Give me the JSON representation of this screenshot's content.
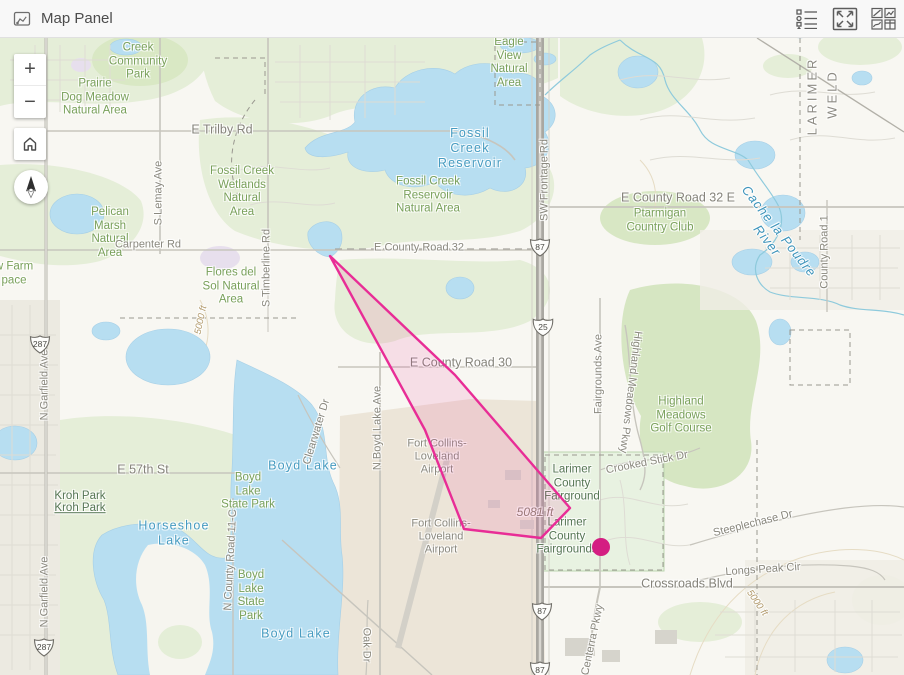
{
  "header": {
    "title": "Map Panel",
    "icons": [
      {
        "name": "legend-icon"
      },
      {
        "name": "expand-icon"
      },
      {
        "name": "panels-icon"
      }
    ]
  },
  "controls": {
    "zoom_in_label": "+",
    "zoom_out_label": "−"
  },
  "map": {
    "colors": {
      "overlay_stroke": "#e82d96",
      "overlay_fill": "rgba(237,45,146,0.12)",
      "dot_fill": "#d41e82"
    },
    "overlay": {
      "polygon": [
        [
          330,
          256
        ],
        [
          455,
          375
        ],
        [
          570,
          508
        ],
        [
          541,
          538
        ],
        [
          464,
          529
        ],
        [
          425,
          430
        ]
      ],
      "dot": {
        "x": 601,
        "y": 547,
        "r": 9
      }
    },
    "shields": [
      {
        "kind": "us",
        "label": "287",
        "x": 40,
        "y": 347
      },
      {
        "kind": "us",
        "label": "287",
        "x": 44,
        "y": 650
      },
      {
        "kind": "us",
        "label": "87",
        "x": 540,
        "y": 250
      },
      {
        "kind": "interstate",
        "label": "25",
        "x": 543,
        "y": 330
      },
      {
        "kind": "us",
        "label": "87",
        "x": 542,
        "y": 614
      },
      {
        "kind": "us",
        "label": "87",
        "x": 540,
        "y": 673
      }
    ],
    "labels": [
      {
        "t": "Creek\nCommunity\nPark",
        "x": 138,
        "y": 62,
        "cls": "park"
      },
      {
        "t": "Prairie\nDog Meadow\nNatural Area",
        "x": 95,
        "y": 98,
        "cls": "park"
      },
      {
        "t": "Fossil Creek\nWetlands\nNatural\nArea",
        "x": 242,
        "y": 192,
        "cls": "park"
      },
      {
        "t": "Fossil Creek\nReservoir\nNatural Area",
        "x": 428,
        "y": 196,
        "cls": "park"
      },
      {
        "t": "Eagle\nView\nNatural\nArea",
        "x": 509,
        "y": 63,
        "cls": "park"
      },
      {
        "t": "Pelican\nMarsh\nNatural\nArea",
        "x": 110,
        "y": 233,
        "cls": "park"
      },
      {
        "t": "Flores del\nSol Natural\nArea",
        "x": 231,
        "y": 287,
        "cls": "park"
      },
      {
        "t": "w Farm\npace",
        "x": 14,
        "y": 274,
        "cls": "park"
      },
      {
        "t": "Ptarmigan\nCountry Club",
        "x": 660,
        "y": 221,
        "cls": "park"
      },
      {
        "t": "Highland\nMeadows\nGolf Course",
        "x": 681,
        "y": 416,
        "cls": "park"
      },
      {
        "t": "Boyd\nLake\nState Park",
        "x": 248,
        "y": 492,
        "cls": "park"
      },
      {
        "t": "Boyd\nLake\nState\nPark",
        "x": 251,
        "y": 596,
        "cls": "park"
      },
      {
        "t": "Kroh Park",
        "x": 80,
        "y": 497,
        "cls": "park-dk"
      },
      {
        "t": "Kroh Park",
        "x": 80,
        "y": 509,
        "cls": "park-dk u"
      },
      {
        "t": "Larimer\nCounty\nFairground",
        "x": 572,
        "y": 484,
        "cls": "park-dk"
      },
      {
        "t": "Larimer\nCounty\nFairgrounds",
        "x": 567,
        "y": 537,
        "cls": "park-dk"
      },
      {
        "t": "Fossil\nCreek\nReservoir",
        "x": 470,
        "y": 148,
        "cls": "water-lg"
      },
      {
        "t": "Boyd Lake",
        "x": 303,
        "y": 466,
        "cls": "water-lg"
      },
      {
        "t": "Boyd Lake",
        "x": 296,
        "y": 634,
        "cls": "water-lg"
      },
      {
        "t": "Horseshoe\nLake",
        "x": 174,
        "y": 533,
        "cls": "water-lg"
      },
      {
        "t": "Cache la Poudre River",
        "x": 773,
        "y": 236,
        "cls": "water-it",
        "rot": 52
      },
      {
        "t": "Fort Collins-\nLoveland\nAirport",
        "x": 437,
        "y": 457,
        "cls": "road"
      },
      {
        "t": "Fort Collins-\nLoveland\nAirport",
        "x": 441,
        "y": 537,
        "cls": "road"
      },
      {
        "t": "E Trilby Rd",
        "x": 222,
        "y": 130,
        "cls": "road-lg"
      },
      {
        "t": "Carpenter Rd",
        "x": 148,
        "y": 245,
        "cls": "road"
      },
      {
        "t": "E County Road 32",
        "x": 419,
        "y": 248,
        "cls": "road"
      },
      {
        "t": "E County Road 30",
        "x": 461,
        "y": 363,
        "cls": "road-lg"
      },
      {
        "t": "E County Road 32 E",
        "x": 678,
        "y": 198,
        "cls": "road-lg"
      },
      {
        "t": "E 57th St",
        "x": 143,
        "y": 470,
        "cls": "road-lg"
      },
      {
        "t": "Crossroads Blvd",
        "x": 687,
        "y": 584,
        "cls": "road-lg"
      },
      {
        "t": "Longs Peak Cir",
        "x": 763,
        "y": 570,
        "cls": "road",
        "rot": -4
      },
      {
        "t": "Steeplechase Dr",
        "x": 753,
        "y": 524,
        "cls": "road",
        "rot": -14
      },
      {
        "t": "Crooked Stick Dr",
        "x": 647,
        "y": 463,
        "cls": "road",
        "rot": -11
      },
      {
        "t": "S Lemay Ave",
        "x": 159,
        "y": 193,
        "cls": "road",
        "rot": -90
      },
      {
        "t": "S Timberline Rd",
        "x": 267,
        "y": 268,
        "cls": "road",
        "rot": -90
      },
      {
        "t": "N Boyd Lake Ave",
        "x": 378,
        "y": 428,
        "cls": "road",
        "rot": -90
      },
      {
        "t": "Clearwater Dr",
        "x": 317,
        "y": 432,
        "cls": "road",
        "rot": -73
      },
      {
        "t": "Fairgrounds Ave",
        "x": 599,
        "y": 374,
        "cls": "road",
        "rot": -90
      },
      {
        "t": "Highland Meadows Pkwy",
        "x": 630,
        "y": 392,
        "cls": "road",
        "rot": 97
      },
      {
        "t": "SW Frontage Rd",
        "x": 545,
        "y": 180,
        "cls": "road",
        "rot": -90
      },
      {
        "t": "N Garfield Ave",
        "x": 45,
        "y": 385,
        "cls": "road",
        "rot": -90
      },
      {
        "t": "N Garfield Ave",
        "x": 45,
        "y": 592,
        "cls": "road",
        "rot": -90
      },
      {
        "t": "N County Road 11-C",
        "x": 231,
        "y": 560,
        "cls": "road",
        "rot": -87
      },
      {
        "t": "County Road 1",
        "x": 825,
        "y": 252,
        "cls": "road",
        "rot": -90
      },
      {
        "t": "Centerra Pkwy",
        "x": 593,
        "y": 640,
        "cls": "road",
        "rot": -78
      },
      {
        "t": "Oak Dr",
        "x": 366,
        "y": 645,
        "cls": "road",
        "rot": 90
      },
      {
        "t": "LARIMER",
        "x": 812,
        "y": 96,
        "cls": "county",
        "rot": -90
      },
      {
        "t": "WELD",
        "x": 832,
        "y": 94,
        "cls": "county",
        "rot": -90
      },
      {
        "t": "5000 ft",
        "x": 201,
        "y": 320,
        "cls": "contour",
        "rot": -78
      },
      {
        "t": "5000 ft",
        "x": 757,
        "y": 603,
        "cls": "contour",
        "rot": 55
      },
      {
        "t": "5081 ft",
        "x": 535,
        "y": 512,
        "cls": "elev"
      }
    ]
  }
}
